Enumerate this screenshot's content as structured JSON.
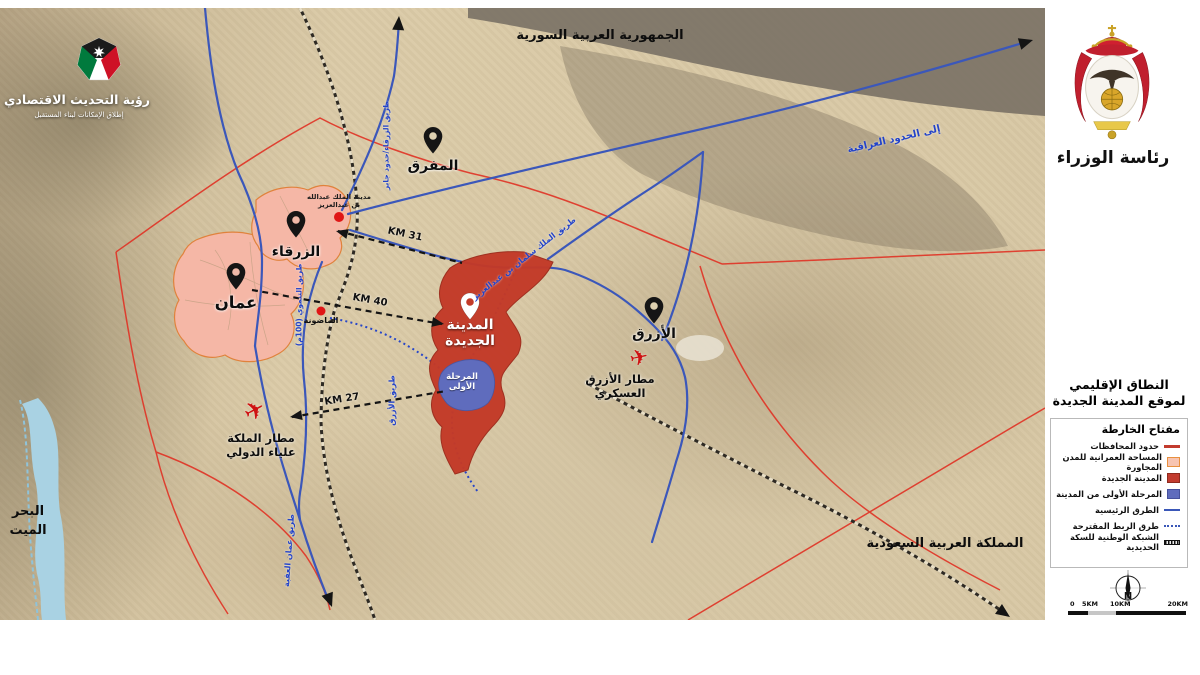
{
  "branding": {
    "vision_title": "رؤية التحديث الاقتصادي",
    "vision_subtitle": "إطلاق الإمكانات لبناء المستقبل",
    "pm_title": "رئاسة الوزراء"
  },
  "regions": {
    "syria": "الجمهورية العربية السورية",
    "saudi_arabia": "المملكة العربية السعودية",
    "dead_sea_line1": "البحر",
    "dead_sea_line2": "الميت"
  },
  "places": {
    "mafraq": "المفرق",
    "zarqa": "الزرقاء",
    "amman": "عمان",
    "azraq": "الأزرق",
    "new_city_line1": "المدينة",
    "new_city_line2": "الجديدة",
    "phase1_line1": "المرحلة",
    "phase1_line2": "الأولى",
    "king_abdullah_city_line1": "مدينة الملك عبدالله",
    "king_abdullah_city_line2": "بن عبدالعزيز",
    "madouneh": "الماضونة"
  },
  "airports": {
    "queen_alia_line1": "مطار الملكة",
    "queen_alia_line2": "علياء الدولي",
    "azraq_military_line1": "مطار الأزرق",
    "azraq_military_line2": "العسكري"
  },
  "distances": {
    "to_zarqa": "31 KM",
    "to_amman": "40 KM",
    "to_airport": "27 KM"
  },
  "road_labels": {
    "zarqa_jaber": "طريق الزرقاء/حدود جابر",
    "to_iraq": "إلى الحدود العراقية",
    "king_salman": "طريق الملك سلمان بن عبدالعزيز",
    "tanmawi": "طريق التنموي (100م)",
    "azraq_road": "طريق الأزرق",
    "amman_aqaba": "طريق عمان العقبة"
  },
  "legend": {
    "title_line1": "النطاق الإقليمي",
    "title_line2": "لموقع المدينة الجديدة",
    "key_title": "مفتاح الخارطة",
    "items": [
      {
        "label": "حدود المحافظات",
        "type": "line-red",
        "color": "#c23b2e"
      },
      {
        "label": "المساحة العمرانية للمدن المجاورة",
        "type": "box-pink",
        "color": "#f7c4b1"
      },
      {
        "label": "المدينة الجديدة",
        "type": "box-red",
        "color": "#c23b2e"
      },
      {
        "label": "المرحلة الأولى من المدينة",
        "type": "box-blue",
        "color": "#5f6cbd"
      },
      {
        "label": "الطرق الرئيسية",
        "type": "line-blue",
        "color": "#3a57b8"
      },
      {
        "label": "طرق الربط المقترحة",
        "type": "dots-blue",
        "color": "#3a57b8"
      },
      {
        "label": "الشبكة الوطنية للسكة الحديدية",
        "type": "rail",
        "color": "#111111"
      }
    ]
  },
  "icons": {
    "airport_icon": "✈"
  },
  "compass_north": "N",
  "scale_ticks": [
    "0",
    "5KM",
    "10KM",
    "20KM"
  ],
  "colors": {
    "new_city": "#c33a28",
    "phase1": "#5f6cbd",
    "urban_area": "#f5b7a6",
    "main_road": "#3a57b8",
    "governorate_border": "#e03527"
  }
}
